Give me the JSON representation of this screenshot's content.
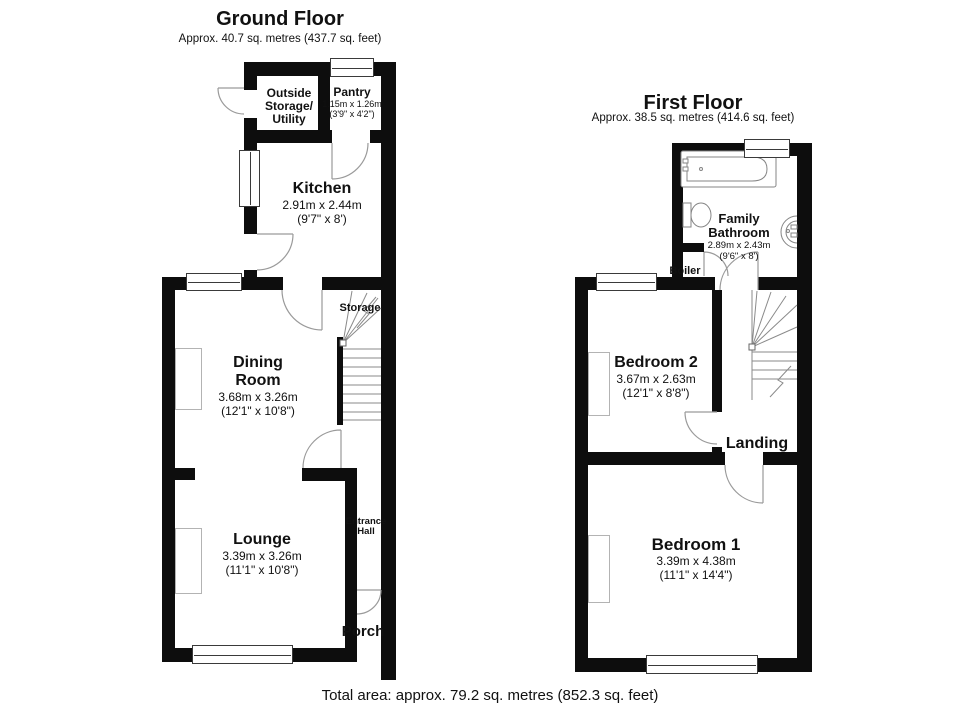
{
  "meta": {
    "background": "#ffffff",
    "wall_color": "#0d0d0d",
    "fixture_line_color": "#8a8a8a",
    "text_color": "#111111"
  },
  "ground_floor": {
    "title": "Ground Floor",
    "subtitle": "Approx. 40.7 sq. metres (437.7 sq. feet)",
    "rooms": {
      "outside_storage": {
        "line1": "Outside",
        "line2": "Storage/",
        "line3": "Utility"
      },
      "pantry": {
        "name": "Pantry",
        "metric": "1.15m x 1.26m",
        "imperial": "(3'9\" x 4'2\")"
      },
      "kitchen": {
        "name": "Kitchen",
        "metric": "2.91m x 2.44m",
        "imperial": "(9'7\" x 8')"
      },
      "dining_room": {
        "line1": "Dining",
        "line2": "Room",
        "metric": "3.68m x 3.26m",
        "imperial": "(12'1\" x 10'8\")"
      },
      "lounge": {
        "name": "Lounge",
        "metric": "3.39m x 3.26m",
        "imperial": "(11'1\" x 10'8\")"
      }
    },
    "labels": {
      "storage": "Storage",
      "entrance_hall_line1": "Entrance",
      "entrance_hall_line2": "Hall",
      "porch": "Porch"
    }
  },
  "first_floor": {
    "title": "First Floor",
    "subtitle": "Approx. 38.5 sq. metres (414.6 sq. feet)",
    "rooms": {
      "family_bathroom": {
        "line1": "Family",
        "line2": "Bathroom",
        "metric": "2.89m x 2.43m",
        "imperial": "(9'6\" x 8')"
      },
      "bedroom_2": {
        "name": "Bedroom 2",
        "metric": "3.67m x 2.63m",
        "imperial": "(12'1\" x 8'8\")"
      },
      "bedroom_1": {
        "name": "Bedroom 1",
        "metric": "3.39m x 4.38m",
        "imperial": "(11'1\" x 14'4\")"
      }
    },
    "labels": {
      "boiler": "Boiler",
      "landing": "Landing"
    }
  },
  "footer": {
    "total_area": "Total area: approx. 79.2 sq. metres (852.3 sq. feet)"
  }
}
